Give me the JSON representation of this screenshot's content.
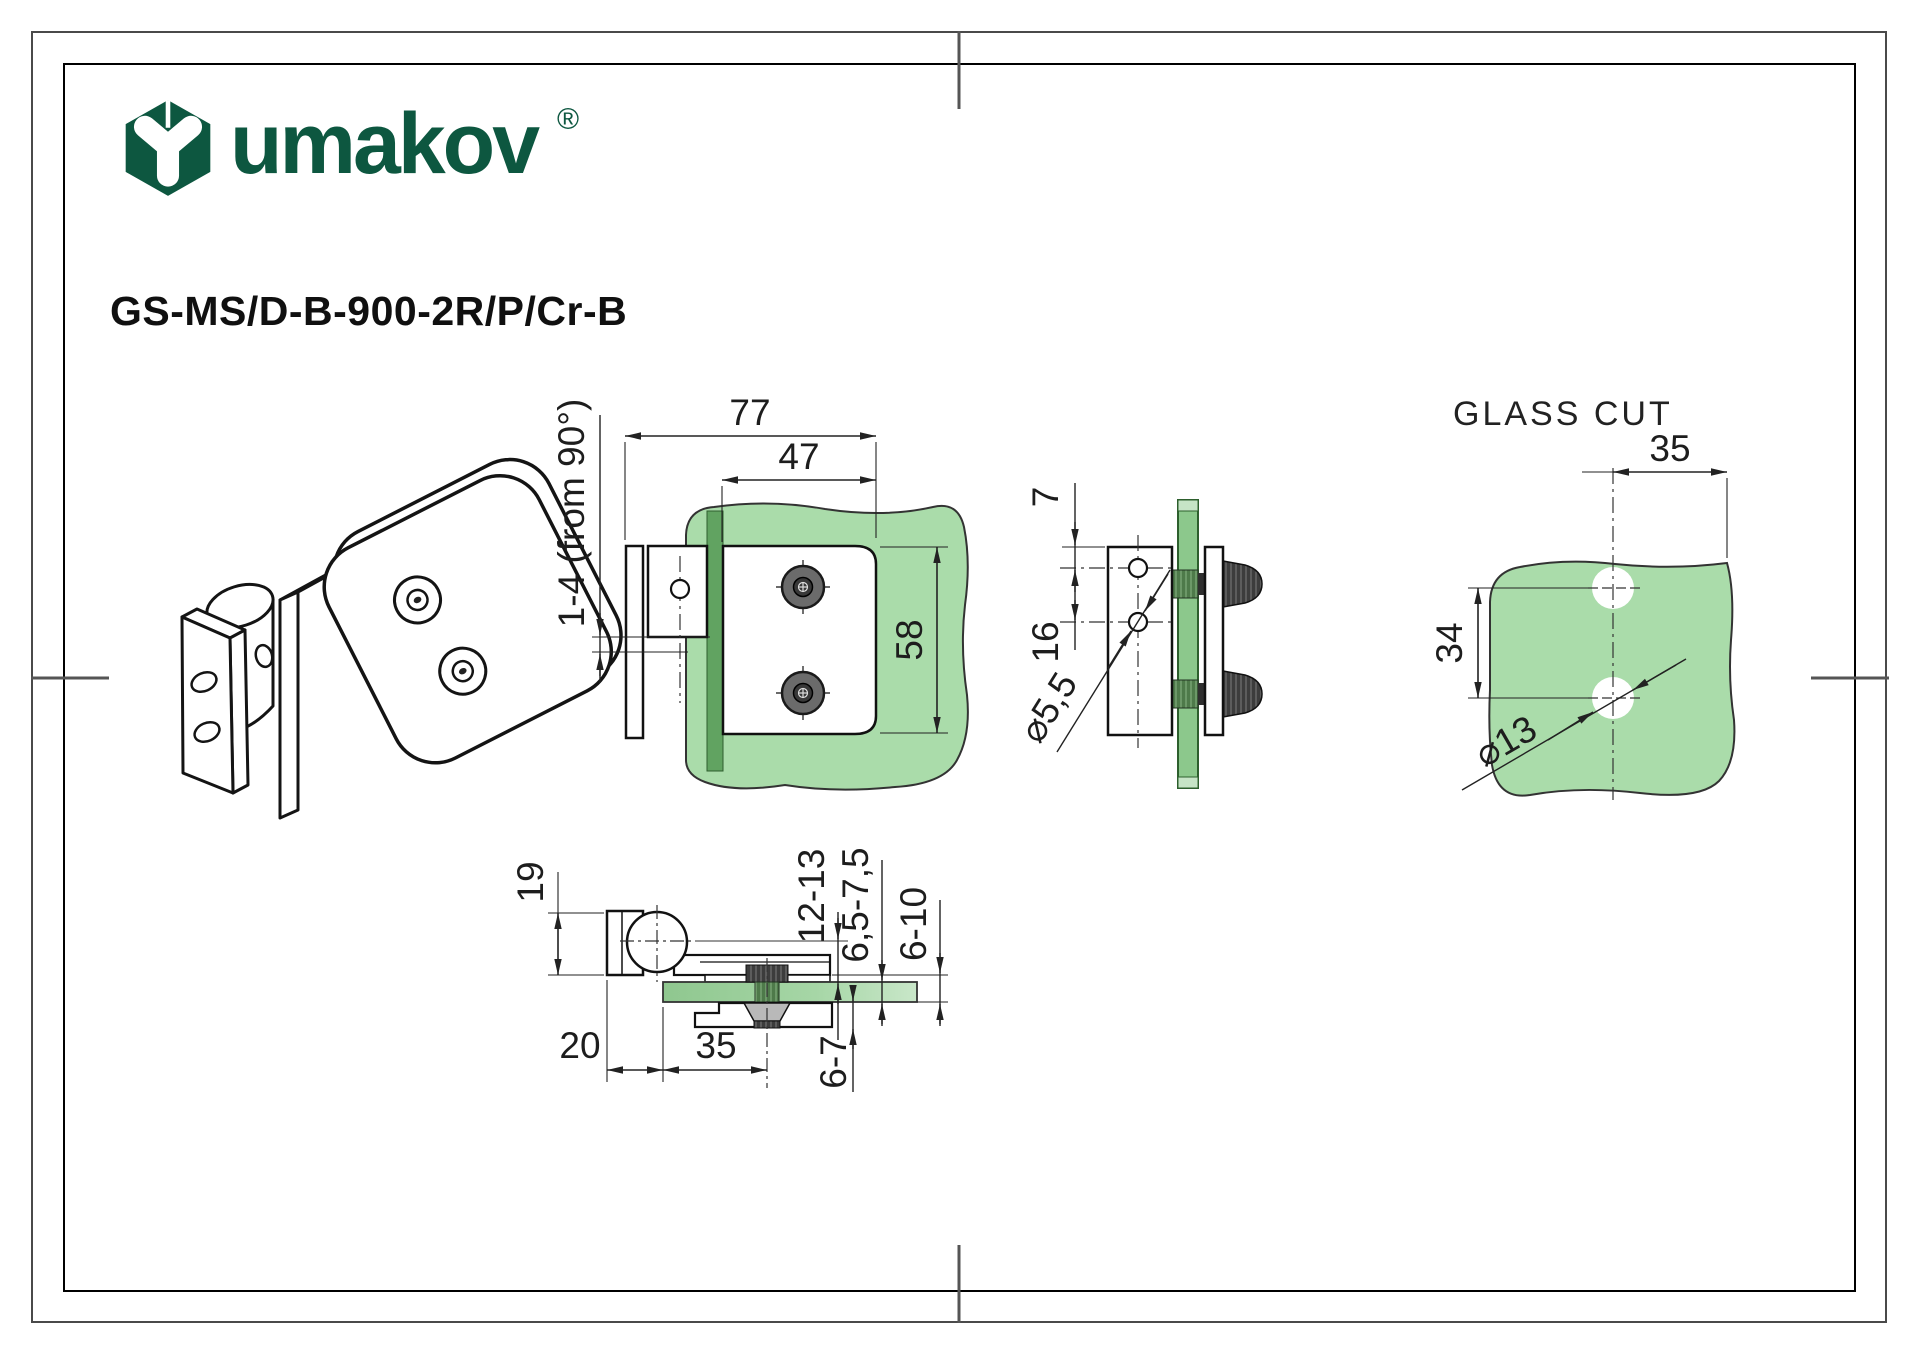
{
  "brand": {
    "wordmark": "umakov",
    "registered_mark": "®",
    "logo_color": "#0d5740"
  },
  "document": {
    "product_code": "GS-MS/D-B-900-2R/P/Cr-B"
  },
  "views": {
    "front": {
      "dim_total_width": "77",
      "dim_plate_width": "47",
      "dim_plate_height": "58",
      "dim_adjustability": "1-4 (from 90°)"
    },
    "side": {
      "dim_hole_edge_offset": "7",
      "dim_hole_spacing": "16",
      "dim_hole_diameter": "⌀5,5"
    },
    "glass_cut": {
      "title": "GLASS CUT",
      "dim_hole_edge_distance": "35",
      "dim_hole_spacing": "34",
      "dim_hole_diameter": "⌀13"
    },
    "bottom": {
      "dim_knuckle_width": "19",
      "dim_pivot_to_glass": "12-13",
      "dim_glass_thickness": "6,5-7,5",
      "dim_clamp_gap": "6-10",
      "dim_cover_plate": "6-7",
      "dim_wall_offset": "20",
      "dim_screw_distance": "35"
    }
  },
  "colors": {
    "glass_fill": "#aadcaa",
    "glass_fill_dark": "#8cc88c",
    "glass_edge_band": "#61a361",
    "line": "#111111",
    "dimension_text": "#1d1d1d"
  }
}
